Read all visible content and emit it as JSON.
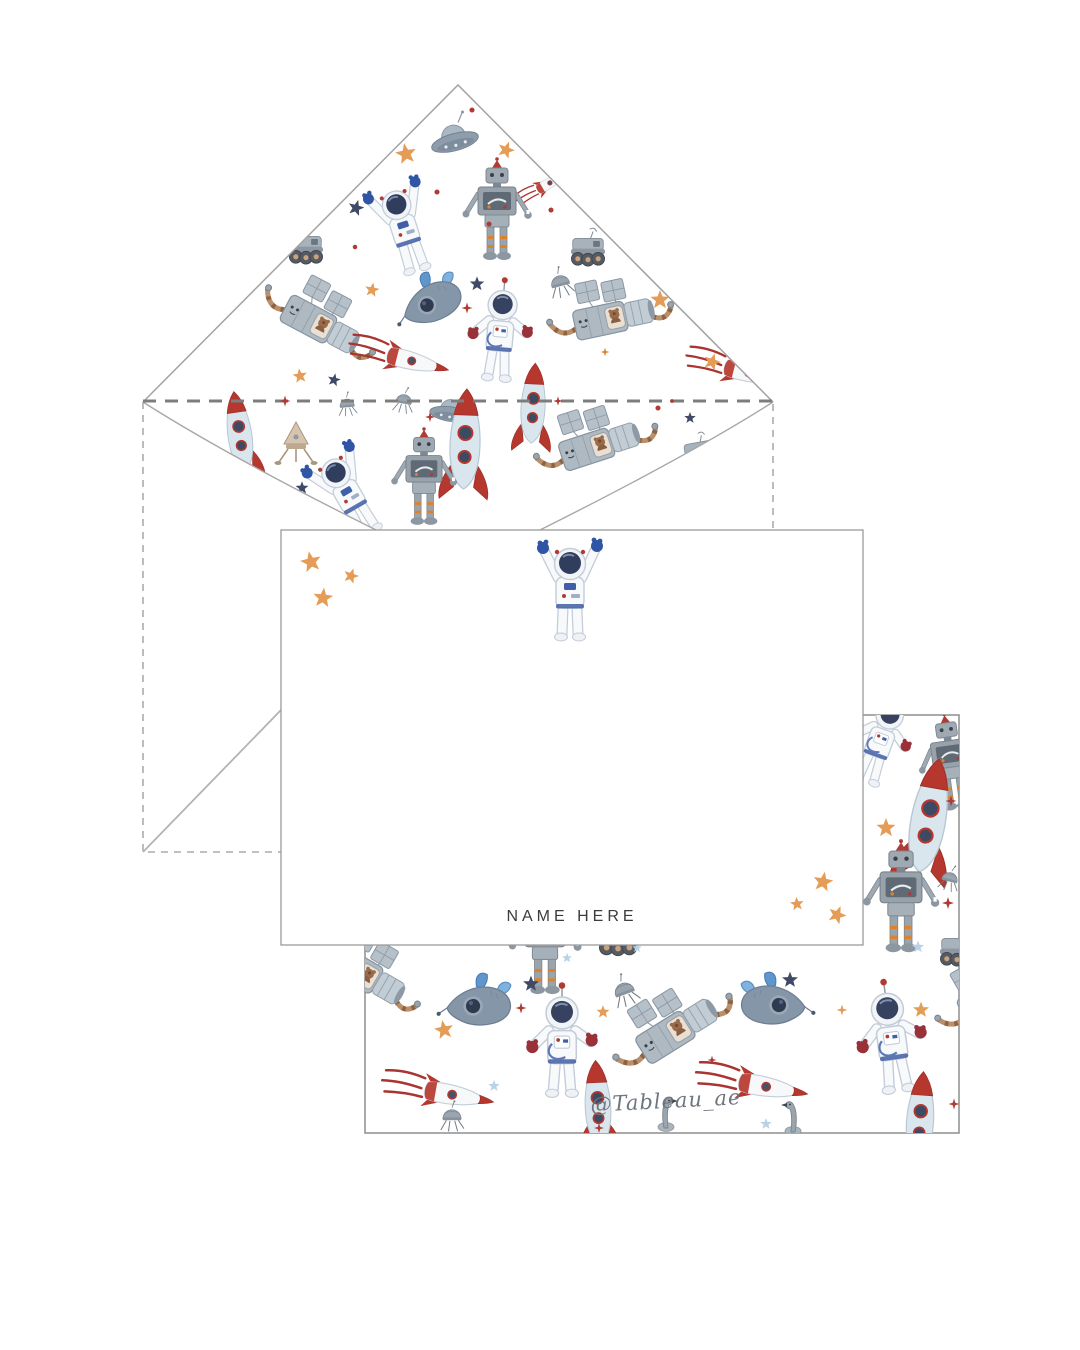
{
  "card_front": {
    "name_label": "NAME HERE"
  },
  "card_back": {
    "signature": "@Tableau_ae"
  },
  "colors": {
    "accent_red": "#b03a34",
    "accent_orange": "#e49c57",
    "navy_star": "#3e4a66",
    "light_blue_star": "#b9d2e6",
    "glove_blue": "#2f55a4",
    "glove_red": "#993139",
    "rocket_red": "#b5372e",
    "outline_gray": "#a8a8a8",
    "name_text": "#3c3c3c",
    "signature_gray": "#6e757d"
  },
  "patterns": {
    "liner": [
      {
        "m": "dot",
        "x": 472,
        "y": 110,
        "s": 0.8,
        "c": "#b03a34"
      },
      {
        "m": "ufo",
        "x": 455,
        "y": 142,
        "s": 1,
        "r": -15
      },
      {
        "m": "star5",
        "x": 406,
        "y": 154,
        "s": 0.55,
        "r": -10,
        "c": "#e49c57"
      },
      {
        "m": "star5",
        "x": 506,
        "y": 150,
        "s": 0.45,
        "r": 20,
        "c": "#e49c57"
      },
      {
        "m": "rocket-striped",
        "x": 548,
        "y": 184,
        "s": 0.55,
        "r": -30
      },
      {
        "m": "dot",
        "x": 437,
        "y": 192,
        "s": 0.8,
        "c": "#b03a34"
      },
      {
        "m": "star5",
        "x": 356,
        "y": 208,
        "s": 0.42,
        "r": 15,
        "c": "#3e4a66"
      },
      {
        "m": "robot",
        "x": 497,
        "y": 218,
        "s": 1
      },
      {
        "m": "astronaut-up",
        "x": 404,
        "y": 228,
        "s": 0.92,
        "r": -18
      },
      {
        "m": "dot",
        "x": 489,
        "y": 224,
        "s": 0.8,
        "c": "#b03a34"
      },
      {
        "m": "dot",
        "x": 551,
        "y": 210,
        "s": 0.8,
        "c": "#b03a34"
      },
      {
        "m": "rover",
        "x": 306,
        "y": 250,
        "s": 0.85
      },
      {
        "m": "rover",
        "x": 588,
        "y": 252,
        "s": 0.85
      },
      {
        "m": "dot",
        "x": 355,
        "y": 247,
        "s": 0.7,
        "c": "#b03a34"
      },
      {
        "m": "sputnik",
        "x": 560,
        "y": 282,
        "s": 0.7,
        "r": -15
      },
      {
        "m": "whale",
        "x": 432,
        "y": 300,
        "s": 1,
        "r": -12
      },
      {
        "m": "star5",
        "x": 477,
        "y": 284,
        "s": 0.38,
        "c": "#3e4a66"
      },
      {
        "m": "star5",
        "x": 372,
        "y": 290,
        "s": 0.38,
        "r": 10,
        "c": "#e49c57"
      },
      {
        "m": "star5",
        "x": 660,
        "y": 300,
        "s": 0.5,
        "c": "#e49c57"
      },
      {
        "m": "star4",
        "x": 467,
        "y": 308,
        "s": 0.5,
        "c": "#b03a34"
      },
      {
        "m": "satellite",
        "x": 316,
        "y": 322,
        "s": 1,
        "r": 28
      },
      {
        "m": "satellite",
        "x": 608,
        "y": 318,
        "s": 1,
        "r": -12
      },
      {
        "m": "astronaut-pat",
        "x": 500,
        "y": 335,
        "s": 1,
        "r": 5
      },
      {
        "m": "rocket-striped",
        "x": 408,
        "y": 360,
        "s": 0.95,
        "r": 14
      },
      {
        "m": "rocket-striped",
        "x": 745,
        "y": 372,
        "s": 0.95,
        "r": 14
      },
      {
        "m": "star5",
        "x": 712,
        "y": 362,
        "s": 0.45,
        "r": 18,
        "c": "#e49c57"
      },
      {
        "m": "star4",
        "x": 605,
        "y": 352,
        "s": 0.4,
        "c": "#d9832e"
      },
      {
        "m": "star5",
        "x": 300,
        "y": 376,
        "s": 0.38,
        "r": -8,
        "c": "#e49c57"
      },
      {
        "m": "star5",
        "x": 334,
        "y": 380,
        "s": 0.34,
        "r": 12,
        "c": "#3e4a66"
      },
      {
        "m": "sputnik",
        "x": 404,
        "y": 400,
        "s": 0.6,
        "r": 10
      },
      {
        "m": "sputnik",
        "x": 347,
        "y": 404,
        "s": 0.55,
        "r": -5
      },
      {
        "m": "ufo",
        "x": 450,
        "y": 414,
        "s": 0.85,
        "r": 8
      },
      {
        "m": "star4",
        "x": 430,
        "y": 417,
        "s": 0.45,
        "c": "#b03a34"
      },
      {
        "m": "rocket-tall",
        "x": 533,
        "y": 408,
        "s": 0.8,
        "r": 3
      },
      {
        "m": "rocket-tall",
        "x": 240,
        "y": 436,
        "s": 0.8,
        "r": -8
      },
      {
        "m": "lander",
        "x": 296,
        "y": 442,
        "s": 1
      },
      {
        "m": "rocket-tall",
        "x": 465,
        "y": 445,
        "s": 1,
        "r": 2
      },
      {
        "m": "satellite",
        "x": 594,
        "y": 446,
        "s": 1,
        "r": -18
      },
      {
        "m": "dot",
        "x": 658,
        "y": 408,
        "s": 0.8,
        "c": "#b03a34"
      },
      {
        "m": "star5",
        "x": 690,
        "y": 418,
        "s": 0.3,
        "c": "#3e4a66"
      },
      {
        "m": "rover",
        "x": 700,
        "y": 455,
        "s": 0.8,
        "r": -10
      },
      {
        "m": "dot",
        "x": 740,
        "y": 430,
        "s": 0.8,
        "c": "#b03a34"
      },
      {
        "m": "astronaut-up",
        "x": 348,
        "y": 494,
        "s": 0.92,
        "r": -30
      },
      {
        "m": "robot",
        "x": 424,
        "y": 485,
        "s": 0.95
      },
      {
        "m": "star5",
        "x": 302,
        "y": 488,
        "s": 0.34,
        "c": "#3e4a66"
      }
    ],
    "fold_accents": [
      {
        "m": "star4",
        "x": 285,
        "y": 401,
        "s": 0.5,
        "c": "#b03a34"
      },
      {
        "m": "star4",
        "x": 558,
        "y": 401,
        "s": 0.42,
        "c": "#b03a34"
      },
      {
        "m": "dot",
        "x": 672,
        "y": 401,
        "s": 0.6,
        "c": "#b03a34"
      }
    ],
    "back_card": [
      {
        "m": "astronaut-pat",
        "x": 880,
        "y": 742,
        "s": 0.95,
        "r": 20
      },
      {
        "m": "robot",
        "x": 952,
        "y": 770,
        "s": 0.95,
        "r": -8
      },
      {
        "m": "rocket-tall",
        "x": 928,
        "y": 822,
        "s": 1.15,
        "r": 10
      },
      {
        "m": "star5",
        "x": 886,
        "y": 828,
        "s": 0.5,
        "c": "#e49c57"
      },
      {
        "m": "star4",
        "x": 951,
        "y": 801,
        "s": 0.5,
        "c": "#b03a34"
      },
      {
        "m": "sputnik",
        "x": 950,
        "y": 878,
        "s": 0.6,
        "r": 15
      },
      {
        "m": "robot",
        "x": 901,
        "y": 906,
        "s": 1.1
      },
      {
        "m": "star4",
        "x": 948,
        "y": 903,
        "s": 0.55,
        "c": "#b03a34"
      },
      {
        "m": "rover",
        "x": 957,
        "y": 952,
        "s": 0.85
      },
      {
        "m": "star5",
        "x": 918,
        "y": 947,
        "s": 0.32,
        "c": "#b9d2e6"
      },
      {
        "m": "satellite",
        "x": 992,
        "y": 996,
        "s": 1,
        "r": -30
      },
      {
        "m": "star5",
        "x": 921,
        "y": 1010,
        "s": 0.42,
        "c": "#e49c57"
      },
      {
        "m": "astronaut-pat",
        "x": 892,
        "y": 1042,
        "s": 1.1,
        "r": -8
      },
      {
        "m": "rocket-tall",
        "x": 920,
        "y": 1122,
        "s": 0.9,
        "r": 4
      },
      {
        "m": "star4",
        "x": 954,
        "y": 1104,
        "s": 0.5,
        "c": "#b03a34"
      },
      {
        "m": "robot",
        "x": 545,
        "y": 950,
        "s": 1.05
      },
      {
        "m": "rover",
        "x": 618,
        "y": 940,
        "s": 0.95
      },
      {
        "m": "star5",
        "x": 567,
        "y": 958,
        "s": 0.26,
        "c": "#b9d2e6"
      },
      {
        "m": "star5",
        "x": 637,
        "y": 948,
        "s": 0.25,
        "c": "#b9d2e6"
      },
      {
        "m": "sputnik",
        "x": 624,
        "y": 990,
        "s": 0.75,
        "r": -20
      },
      {
        "m": "whale",
        "x": 480,
        "y": 1003,
        "s": 1.05,
        "r": 10
      },
      {
        "m": "star5",
        "x": 531,
        "y": 984,
        "s": 0.42,
        "c": "#3e4a66"
      },
      {
        "m": "star4",
        "x": 521,
        "y": 1008,
        "s": 0.5,
        "c": "#b03a34"
      },
      {
        "m": "star5",
        "x": 444,
        "y": 1030,
        "s": 0.5,
        "r": -10,
        "c": "#e49c57"
      },
      {
        "m": "satellite",
        "x": 672,
        "y": 1032,
        "s": 1.05,
        "r": -32
      },
      {
        "m": "star5",
        "x": 603,
        "y": 1012,
        "s": 0.34,
        "c": "#e49c57"
      },
      {
        "m": "astronaut-pat",
        "x": 562,
        "y": 1046,
        "s": 1.1
      },
      {
        "m": "whale",
        "x": 772,
        "y": 1002,
        "s": 1.05,
        "r": -10,
        "f": 1
      },
      {
        "m": "star5",
        "x": 790,
        "y": 980,
        "s": 0.42,
        "c": "#3e4a66"
      },
      {
        "m": "star4",
        "x": 842,
        "y": 1010,
        "s": 0.5,
        "c": "#e49c57"
      },
      {
        "m": "satellite",
        "x": 362,
        "y": 972,
        "s": 1,
        "r": 30
      },
      {
        "m": "rocket-striped",
        "x": 448,
        "y": 1094,
        "s": 1.05,
        "r": 10
      },
      {
        "m": "rocket-striped",
        "x": 762,
        "y": 1086,
        "s": 1.05,
        "r": 10
      },
      {
        "m": "star4",
        "x": 712,
        "y": 1060,
        "s": 0.4,
        "c": "#b03a34"
      },
      {
        "m": "rocket-tall",
        "x": 598,
        "y": 1108,
        "s": 0.85,
        "r": -3
      },
      {
        "m": "goose",
        "x": 664,
        "y": 1112,
        "s": 1
      },
      {
        "m": "goose",
        "x": 795,
        "y": 1116,
        "s": 1,
        "f": 1
      },
      {
        "m": "sputnik",
        "x": 452,
        "y": 1116,
        "s": 0.7
      },
      {
        "m": "star5",
        "x": 494,
        "y": 1086,
        "s": 0.3,
        "c": "#b9d2e6"
      },
      {
        "m": "star5",
        "x": 766,
        "y": 1124,
        "s": 0.3,
        "c": "#b9d2e6"
      },
      {
        "m": "star4",
        "x": 599,
        "y": 1128,
        "s": 0.45,
        "c": "#b03a34"
      }
    ],
    "front_card": [
      {
        "m": "star5",
        "x": 311,
        "y": 562,
        "s": 0.55,
        "r": -12,
        "c": "#e49c57"
      },
      {
        "m": "star5",
        "x": 351,
        "y": 576,
        "s": 0.4,
        "r": 18,
        "c": "#e49c57"
      },
      {
        "m": "star5",
        "x": 323,
        "y": 598,
        "s": 0.52,
        "r": 6,
        "c": "#e49c57"
      },
      {
        "m": "astronaut-up",
        "x": 570,
        "y": 590,
        "s": 1
      },
      {
        "m": "star5",
        "x": 823,
        "y": 882,
        "s": 0.52,
        "r": 10,
        "c": "#e49c57"
      },
      {
        "m": "star5",
        "x": 797,
        "y": 904,
        "s": 0.36,
        "r": -6,
        "c": "#e49c57"
      },
      {
        "m": "star5",
        "x": 837,
        "y": 915,
        "s": 0.48,
        "r": 22,
        "c": "#e49c57"
      }
    ]
  }
}
